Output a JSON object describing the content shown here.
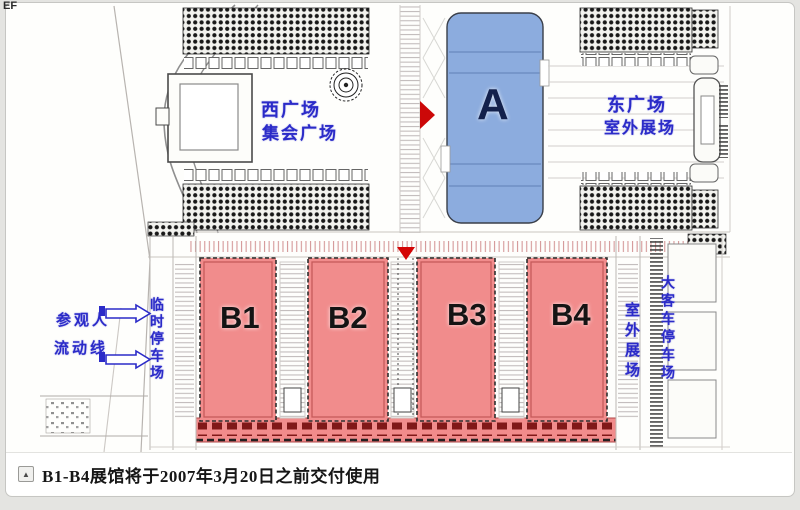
{
  "window": {
    "corner_text": "EF"
  },
  "plan": {
    "hall_a": {
      "label": "A",
      "fill_color": "#8CACDE"
    },
    "hall_b1": {
      "label": "B1"
    },
    "hall_b2": {
      "label": "B2"
    },
    "hall_b3": {
      "label": "B3"
    },
    "hall_b4": {
      "label": "B4"
    },
    "hall_b_fill_color": "#F18C8C",
    "west_square": {
      "line1": "西广场",
      "line2": "集会广场"
    },
    "east_square": {
      "line1": "东广场",
      "line2": "室外展场"
    },
    "visitor_flow": {
      "line1": "参观人",
      "line2": "流动线"
    },
    "temp_parking_label": "临时停车场",
    "outdoor_exhibition_label": "室外展场",
    "bus_parking_label": "大客车停车场",
    "annotation_color": "#2B2BC8",
    "entrance_arrow_color": "#D40404"
  },
  "caption": {
    "collapse_icon": "▲",
    "text": "B1-B4展馆将于2007年3月20日之前交付使用"
  }
}
